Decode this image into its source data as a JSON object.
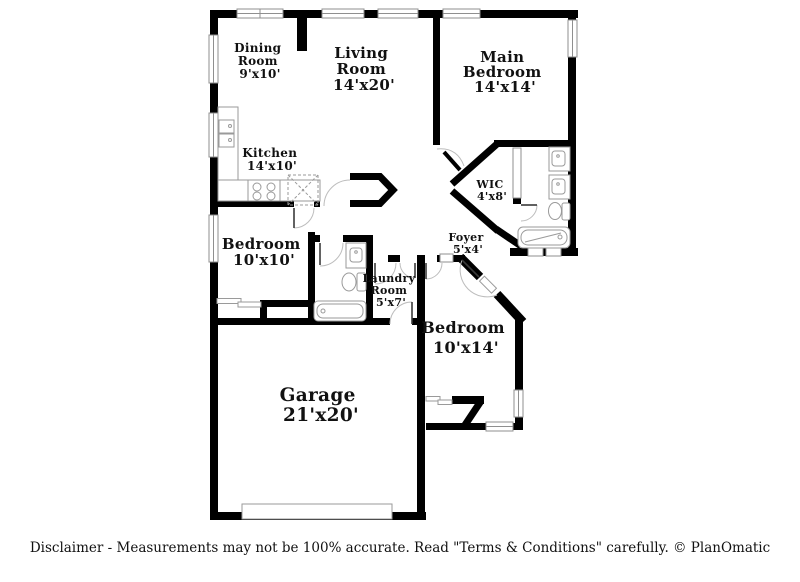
{
  "colors": {
    "wall": "#000000",
    "window_stroke": "#8f8f8f",
    "fixture_stroke": "#9a9a9a",
    "arc": "#bdbdbd",
    "text": "#111111"
  },
  "rooms": {
    "dining": {
      "lines": [
        "Dining",
        "Room",
        "9'x10'"
      ]
    },
    "living": {
      "lines": [
        "Living",
        "Room",
        "14'x20'"
      ]
    },
    "main_bedroom": {
      "lines": [
        "Main",
        "Bedroom",
        "14'x14'"
      ]
    },
    "kitchen": {
      "lines": [
        "Kitchen",
        "14'x10'"
      ]
    },
    "wic": {
      "lines": [
        "WIC",
        "4'x8'"
      ]
    },
    "bedroom_10x10": {
      "lines": [
        "Bedroom",
        "10'x10'"
      ]
    },
    "foyer": {
      "lines": [
        "Foyer",
        "5'x4'"
      ]
    },
    "laundry": {
      "lines": [
        "Laundry",
        "Room",
        "5'x7'"
      ]
    },
    "bedroom_10x14": {
      "lines": [
        "Bedroom",
        "10'x14'"
      ]
    },
    "garage": {
      "lines": [
        "Garage",
        "21'x20'"
      ]
    }
  },
  "footer": {
    "disclaimer": "Disclaimer - Measurements may not be 100% accurate. Read \"Terms & Conditions\" carefully. © PlanOmatic"
  }
}
